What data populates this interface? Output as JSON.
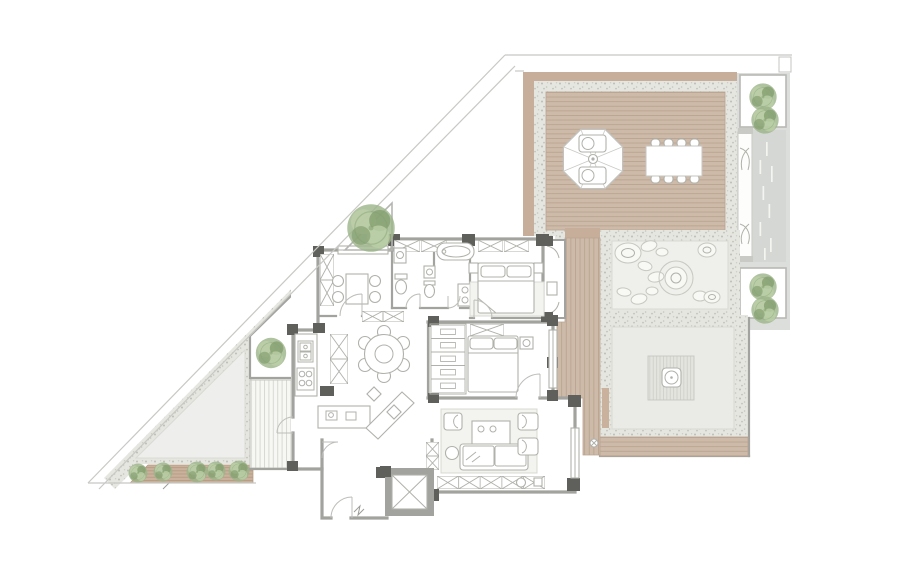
{
  "image": {
    "type": "architectural-floor-plan",
    "description": "Top-view apartment floor plan on a triangular site with roof deck terrace, parasol lounge, outdoor dining table, zen stone garden, paved courtyard with timber platform, tree planters, stepping-stone walkway, bedrooms, bathrooms, kitchen with island bar, living room, elevator and entry hall",
    "width_px": 900,
    "height_px": 568,
    "visible_text": ""
  },
  "colors": {
    "bg": "#ffffff",
    "line_boundary": "#c8c8c4",
    "wall": "#a2a29e",
    "wall_dark": "#5f5f5c",
    "deck_frame": "#c6ae9a",
    "deck_wood": "#cebaa9",
    "deck_line": "#b9a491",
    "gravel": "#e6e6e1",
    "gravel_dot": "#b7b7ae",
    "zen_panel": "#efefeb",
    "court_panel": "#eaeae6",
    "stone_fill": "#f8f8f5",
    "stone_line": "#c8c8c1",
    "walkway": "#d5d7d5",
    "walkway_dash": "#f4f4f1",
    "column_bg": "#dcdedb",
    "stripe_bg": "#f7f7f4",
    "stripe_line": "#d8d8d3",
    "platform_bg": "#e4e4df",
    "platform_line": "#cecec8",
    "plant_strip": "#c9b19d",
    "plant_strip_line": "#b3997f",
    "furn_line": "#b1b1ab",
    "furn_fill": "#ffffff",
    "rug": "#f3f3ef",
    "tree_main": "#9cb489",
    "tree_dark": "#86a070",
    "tree_light": "#bccfa8",
    "panel_line": "#dadad4"
  },
  "inventory": {
    "trees_side_planters": 4,
    "tree_large_terrace": 1,
    "tree_corner_planter": 1,
    "hedge_shrubs": 5,
    "deck_dining_seats": 8,
    "parasol_loungers": 2,
    "dining_chairs": 6,
    "study_chairs": 4,
    "bar_stools": 2,
    "beds": 2,
    "bathtubs": 1,
    "elevators": 1,
    "stone_garden_stones": 12
  }
}
